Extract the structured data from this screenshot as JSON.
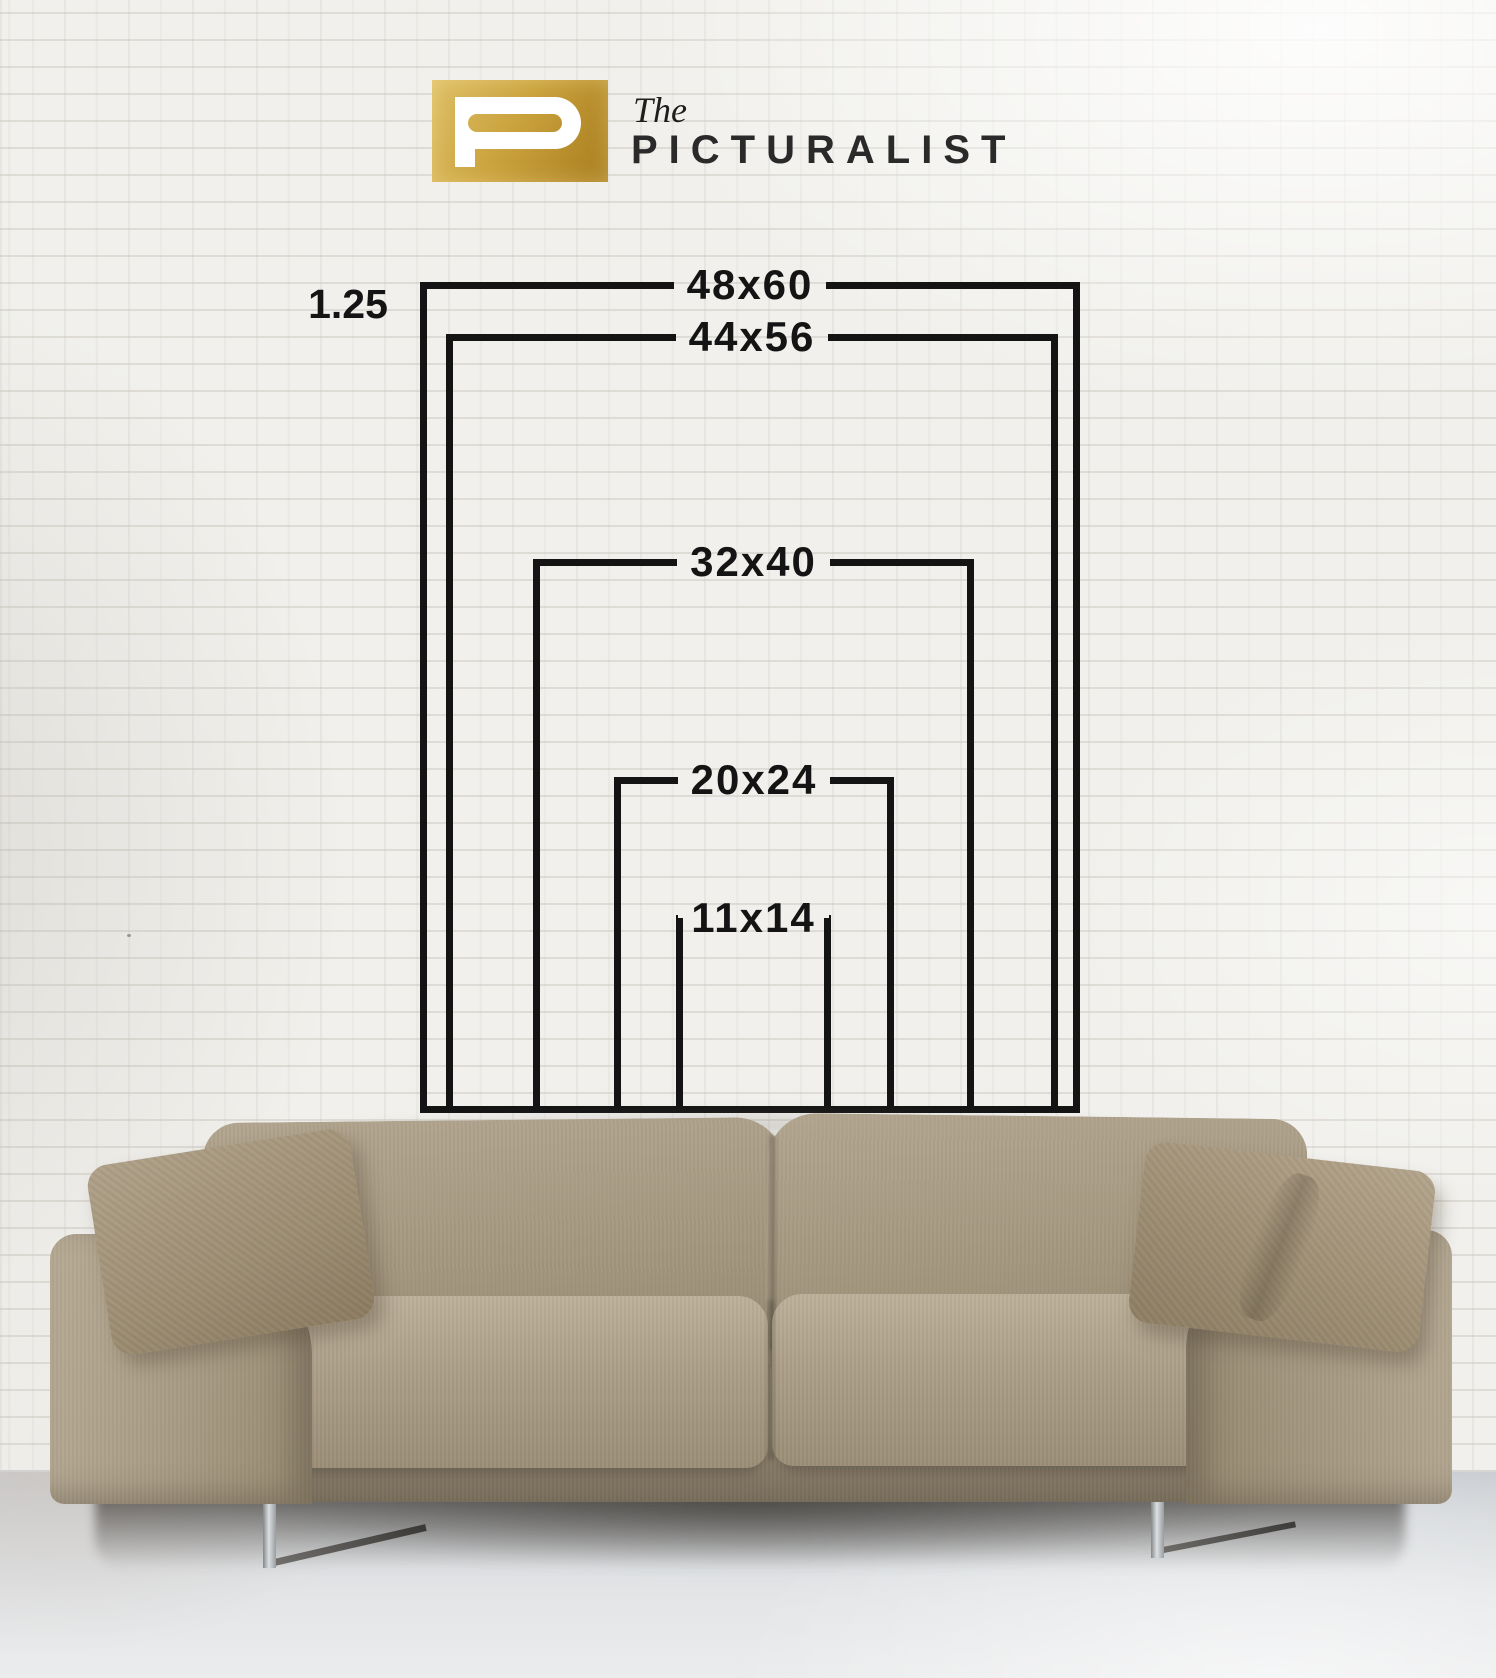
{
  "brand": {
    "mark_letter": "P",
    "prefix": "The",
    "name": "PICTURALIST",
    "mark_gold_color": "#c09a35",
    "text_color": "#2a2a2a"
  },
  "size_chart": {
    "offset_label": "1.25",
    "line_color": "#141414",
    "sizes": [
      {
        "label": "48x60",
        "width_in": 48,
        "height_in": 60
      },
      {
        "label": "44x56",
        "width_in": 44,
        "height_in": 56
      },
      {
        "label": "32x40",
        "width_in": 32,
        "height_in": 40
      },
      {
        "label": "20x24",
        "width_in": 20,
        "height_in": 24
      },
      {
        "label": "11x14",
        "width_in": 11,
        "height_in": 14
      }
    ]
  },
  "scene": {
    "wall_color": "#f1f0ec",
    "mortar_color": "#dedbd5",
    "floor_color": "#dcdfe2",
    "sofa_fabric_color": "#a89b84",
    "pillow_color": "#9c8d72",
    "leg_metal_color": "#b9bcbf",
    "shadow_color": "#3a362f"
  }
}
